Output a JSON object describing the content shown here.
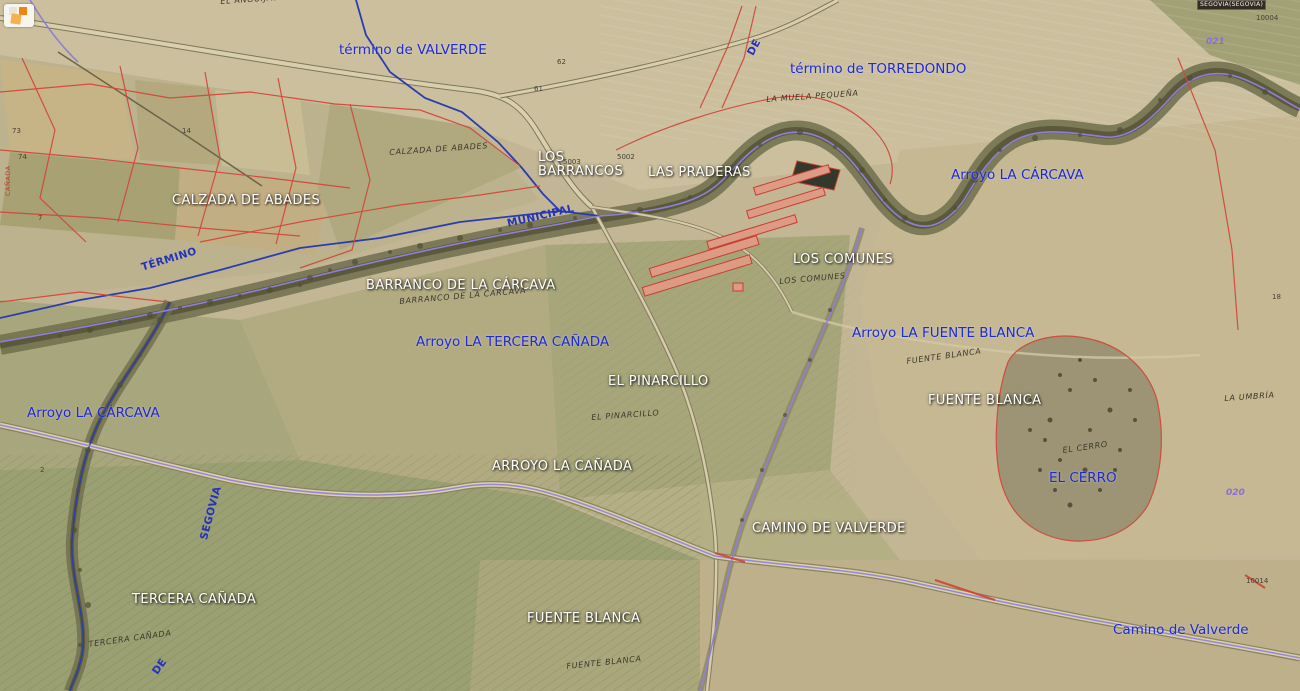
{
  "viewer": {
    "region_box": "SEGOVIA(SEGOVIA)"
  },
  "icons": {
    "corner_logo": "orange-squares-logo"
  },
  "colors": {
    "label_blue": "#1e2bd0",
    "label_white": "#ffffff",
    "cadastral_red": "#d2483a",
    "boundary_blue": "#2a3db0",
    "stream_violet": "#8f7fd8",
    "cadastral_text": "#3c372d",
    "parcel_purple": "#8a6fd6",
    "terrain_base": "#c3b694"
  },
  "labels": [
    {
      "id": "termino-de-valverde",
      "cls": "blue",
      "text": "término de VALVERDE",
      "x": 339,
      "y": 42
    },
    {
      "id": "termino-de-torredondo",
      "cls": "blue",
      "text": "término de TORREDONDO",
      "x": 790,
      "y": 61
    },
    {
      "id": "arroyo-la-carcava-ne",
      "cls": "blue",
      "text": "Arroyo LA CÁRCAVA",
      "x": 951,
      "y": 167
    },
    {
      "id": "arroyo-la-fuente-blanca",
      "cls": "blue",
      "text": "Arroyo LA FUENTE BLANCA",
      "x": 852,
      "y": 325
    },
    {
      "id": "arroyo-la-tercera-canada",
      "cls": "blue",
      "text": "Arroyo LA TERCERA CAÑADA",
      "x": 416,
      "y": 334
    },
    {
      "id": "arroyo-la-carcava-w",
      "cls": "blue",
      "text": "Arroyo LA CÁRCAVA",
      "x": 27,
      "y": 405
    },
    {
      "id": "el-cerro",
      "cls": "blue",
      "text": "EL CERRO",
      "x": 1049,
      "y": 470
    },
    {
      "id": "camino-de-valverde-blue",
      "cls": "blue",
      "text": "Camino de Valverde",
      "x": 1113,
      "y": 622
    },
    {
      "id": "termino-boundary",
      "cls": "blue-rot",
      "text": "TÉRMINO",
      "x": 140,
      "y": 262,
      "rot": -17
    },
    {
      "id": "municipal-boundary",
      "cls": "blue-rot",
      "text": "MUNICIPAL",
      "x": 506,
      "y": 218,
      "rot": -13
    },
    {
      "id": "segovia-road",
      "cls": "blue-rot",
      "text": "SEGOVIA",
      "x": 198,
      "y": 538,
      "rot": -75
    },
    {
      "id": "de-road-north",
      "cls": "blue-rot",
      "text": "DE",
      "x": 745,
      "y": 52,
      "rot": -62
    },
    {
      "id": "de-road-south",
      "cls": "blue-rot",
      "text": "DE",
      "x": 150,
      "y": 670,
      "rot": -55
    },
    {
      "id": "calzada-de-abades",
      "cls": "white",
      "text": "CALZADA DE ABADES",
      "x": 172,
      "y": 193
    },
    {
      "id": "los-barrancos",
      "cls": "white pre",
      "text": "LOS\nBARRANCOS",
      "x": 538,
      "y": 151
    },
    {
      "id": "las-praderas",
      "cls": "white",
      "text": "LAS PRADERAS",
      "x": 648,
      "y": 165
    },
    {
      "id": "los-comunes",
      "cls": "white",
      "text": "LOS COMUNES",
      "x": 793,
      "y": 252
    },
    {
      "id": "barranco-de-la-carcava",
      "cls": "white",
      "text": "BARRANCO DE LA CÁRCAVA",
      "x": 366,
      "y": 278
    },
    {
      "id": "el-pinarcillo",
      "cls": "white",
      "text": "EL PINARCILLO",
      "x": 608,
      "y": 374
    },
    {
      "id": "fuente-blanca-e",
      "cls": "white",
      "text": "FUENTE BLANCA",
      "x": 928,
      "y": 393
    },
    {
      "id": "arroyo-la-canada",
      "cls": "white",
      "text": "ARROYO LA CAÑADA",
      "x": 492,
      "y": 459
    },
    {
      "id": "camino-de-valverde",
      "cls": "white",
      "text": "CAMINO DE VALVERDE",
      "x": 752,
      "y": 521
    },
    {
      "id": "tercera-canada",
      "cls": "white",
      "text": "TERCERA CAÑADA",
      "x": 132,
      "y": 592
    },
    {
      "id": "fuente-blanca-s",
      "cls": "white",
      "text": "FUENTE BLANCA",
      "x": 527,
      "y": 611
    },
    {
      "id": "el-anguijal-cad",
      "cls": "cad",
      "text": "EL ANGUIJAL",
      "x": 220,
      "y": -3,
      "rot": -4
    },
    {
      "id": "calzada-de-abades-cad",
      "cls": "cad",
      "text": "CALZADA DE ABADES",
      "x": 389,
      "y": 148,
      "rot": -4
    },
    {
      "id": "la-muela-pequena-cad",
      "cls": "cad",
      "text": "LA MUELA PEQUEÑA",
      "x": 766,
      "y": 95,
      "rot": -4
    },
    {
      "id": "barranco-cad",
      "cls": "cad",
      "text": "BARRANCO DE LA CARCAVA",
      "x": 399,
      "y": 297,
      "rot": -5
    },
    {
      "id": "los-comunes-cad",
      "cls": "cad",
      "text": "LOS COMUNES",
      "x": 779,
      "y": 277,
      "rot": -5
    },
    {
      "id": "fuente-blanca-cad-n",
      "cls": "cad",
      "text": "FUENTE BLANCA",
      "x": 906,
      "y": 357,
      "rot": -8
    },
    {
      "id": "el-pinarcillo-cad",
      "cls": "cad",
      "text": "EL PINARCILLO",
      "x": 591,
      "y": 413,
      "rot": -4
    },
    {
      "id": "el-cerro-cad",
      "cls": "cad",
      "text": "EL CERRO",
      "x": 1062,
      "y": 446,
      "rot": -8
    },
    {
      "id": "la-umbria-cad",
      "cls": "cad",
      "text": "LA UMBRÍA",
      "x": 1224,
      "y": 394,
      "rot": -4
    },
    {
      "id": "tercera-canada-cad",
      "cls": "cad",
      "text": "TERCERA CAÑADA",
      "x": 88,
      "y": 640,
      "rot": -8
    },
    {
      "id": "fuente-blanca-cad-s",
      "cls": "cad",
      "text": "FUENTE BLANCA",
      "x": 566,
      "y": 662,
      "rot": -6
    },
    {
      "id": "canada-red",
      "cls": "red-rot",
      "text": "CAÑADA",
      "x": 4,
      "y": 196,
      "rot": -90
    },
    {
      "id": "parcel-021",
      "cls": "purple",
      "text": "021",
      "x": 1206,
      "y": 37
    },
    {
      "id": "parcel-020",
      "cls": "purple",
      "text": "020",
      "x": 1226,
      "y": 488
    },
    {
      "id": "parcel-10004",
      "cls": "num",
      "text": "10004",
      "x": 1256,
      "y": 14
    },
    {
      "id": "parcel-10014",
      "cls": "num",
      "text": "10014",
      "x": 1246,
      "y": 577
    },
    {
      "id": "parcel-5003",
      "cls": "num",
      "text": "5003",
      "x": 563,
      "y": 158
    },
    {
      "id": "parcel-5002",
      "cls": "num",
      "text": "5002",
      "x": 617,
      "y": 153
    },
    {
      "id": "parcel-61",
      "cls": "num",
      "text": "61",
      "x": 534,
      "y": 85
    },
    {
      "id": "parcel-62",
      "cls": "num",
      "text": "62",
      "x": 557,
      "y": 58
    },
    {
      "id": "parcel-14",
      "cls": "num",
      "text": "14",
      "x": 182,
      "y": 127
    },
    {
      "id": "parcel-73",
      "cls": "num",
      "text": "73",
      "x": 12,
      "y": 127
    },
    {
      "id": "parcel-74",
      "cls": "num",
      "text": "74",
      "x": 18,
      "y": 153
    },
    {
      "id": "parcel-7",
      "cls": "num",
      "text": "7",
      "x": 38,
      "y": 214
    },
    {
      "id": "parcel-18",
      "cls": "num",
      "text": "18",
      "x": 1272,
      "y": 293
    },
    {
      "id": "parcel-2",
      "cls": "num",
      "text": "2",
      "x": 40,
      "y": 466
    }
  ]
}
